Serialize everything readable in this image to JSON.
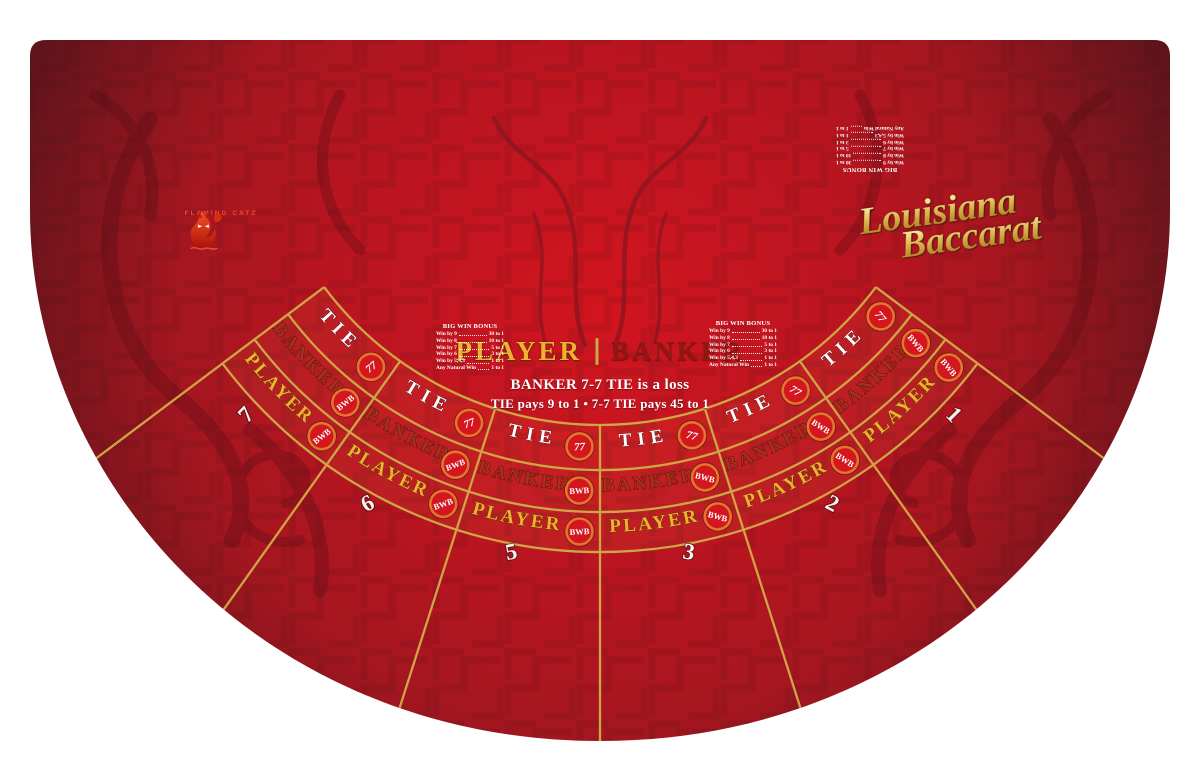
{
  "title_script": {
    "line1": "Louisiana",
    "line2": "Baccarat"
  },
  "brand": {
    "name": "FLAMING CATZ",
    "icon": "flaming-cat-icon"
  },
  "table": {
    "center_left_label": "PLAYER",
    "center_divider": "|",
    "center_right_label": "BANKER",
    "rule_line1": "BANKER  7-7 TIE is a loss",
    "rule_line2": "TIE pays 9 to 1  •  7-7 TIE pays 45 to 1"
  },
  "bonus_paytable": {
    "title": "BIG WIN BONUS",
    "rows": [
      {
        "label": "Win by 9",
        "pays": "30 to 1"
      },
      {
        "label": "Win by 8",
        "pays": "10 to 1"
      },
      {
        "label": "Win by 7",
        "pays": "5 to 1"
      },
      {
        "label": "Win by 6",
        "pays": "3 to 1"
      },
      {
        "label": "Win by 5,4,3",
        "pays": "1 to 1"
      },
      {
        "label": "Any Natural Win",
        "pays": "1 to 1"
      }
    ]
  },
  "betting": {
    "rows": [
      {
        "key": "tie",
        "label": "TIE",
        "badge": "77"
      },
      {
        "key": "banker",
        "label": "BANKER",
        "badge": "BWB"
      },
      {
        "key": "player",
        "label": "PLAYER",
        "badge": "BWB"
      }
    ],
    "seats": [
      "7",
      "6",
      "5",
      "3",
      "2",
      "1"
    ]
  },
  "colors": {
    "felt_center": "#d2151f",
    "felt_mid": "#a51620",
    "felt_edge": "#5f141b",
    "gold_line": "#cfa545",
    "player_gold": "#eeb22e",
    "banker_red": "#a8301c",
    "tie_white": "#ffffff",
    "badge_red": "#d4161f",
    "badge_ring": "#e1762d",
    "brand_orange": "#ef4a2e",
    "script_gold": "#dfba56"
  }
}
